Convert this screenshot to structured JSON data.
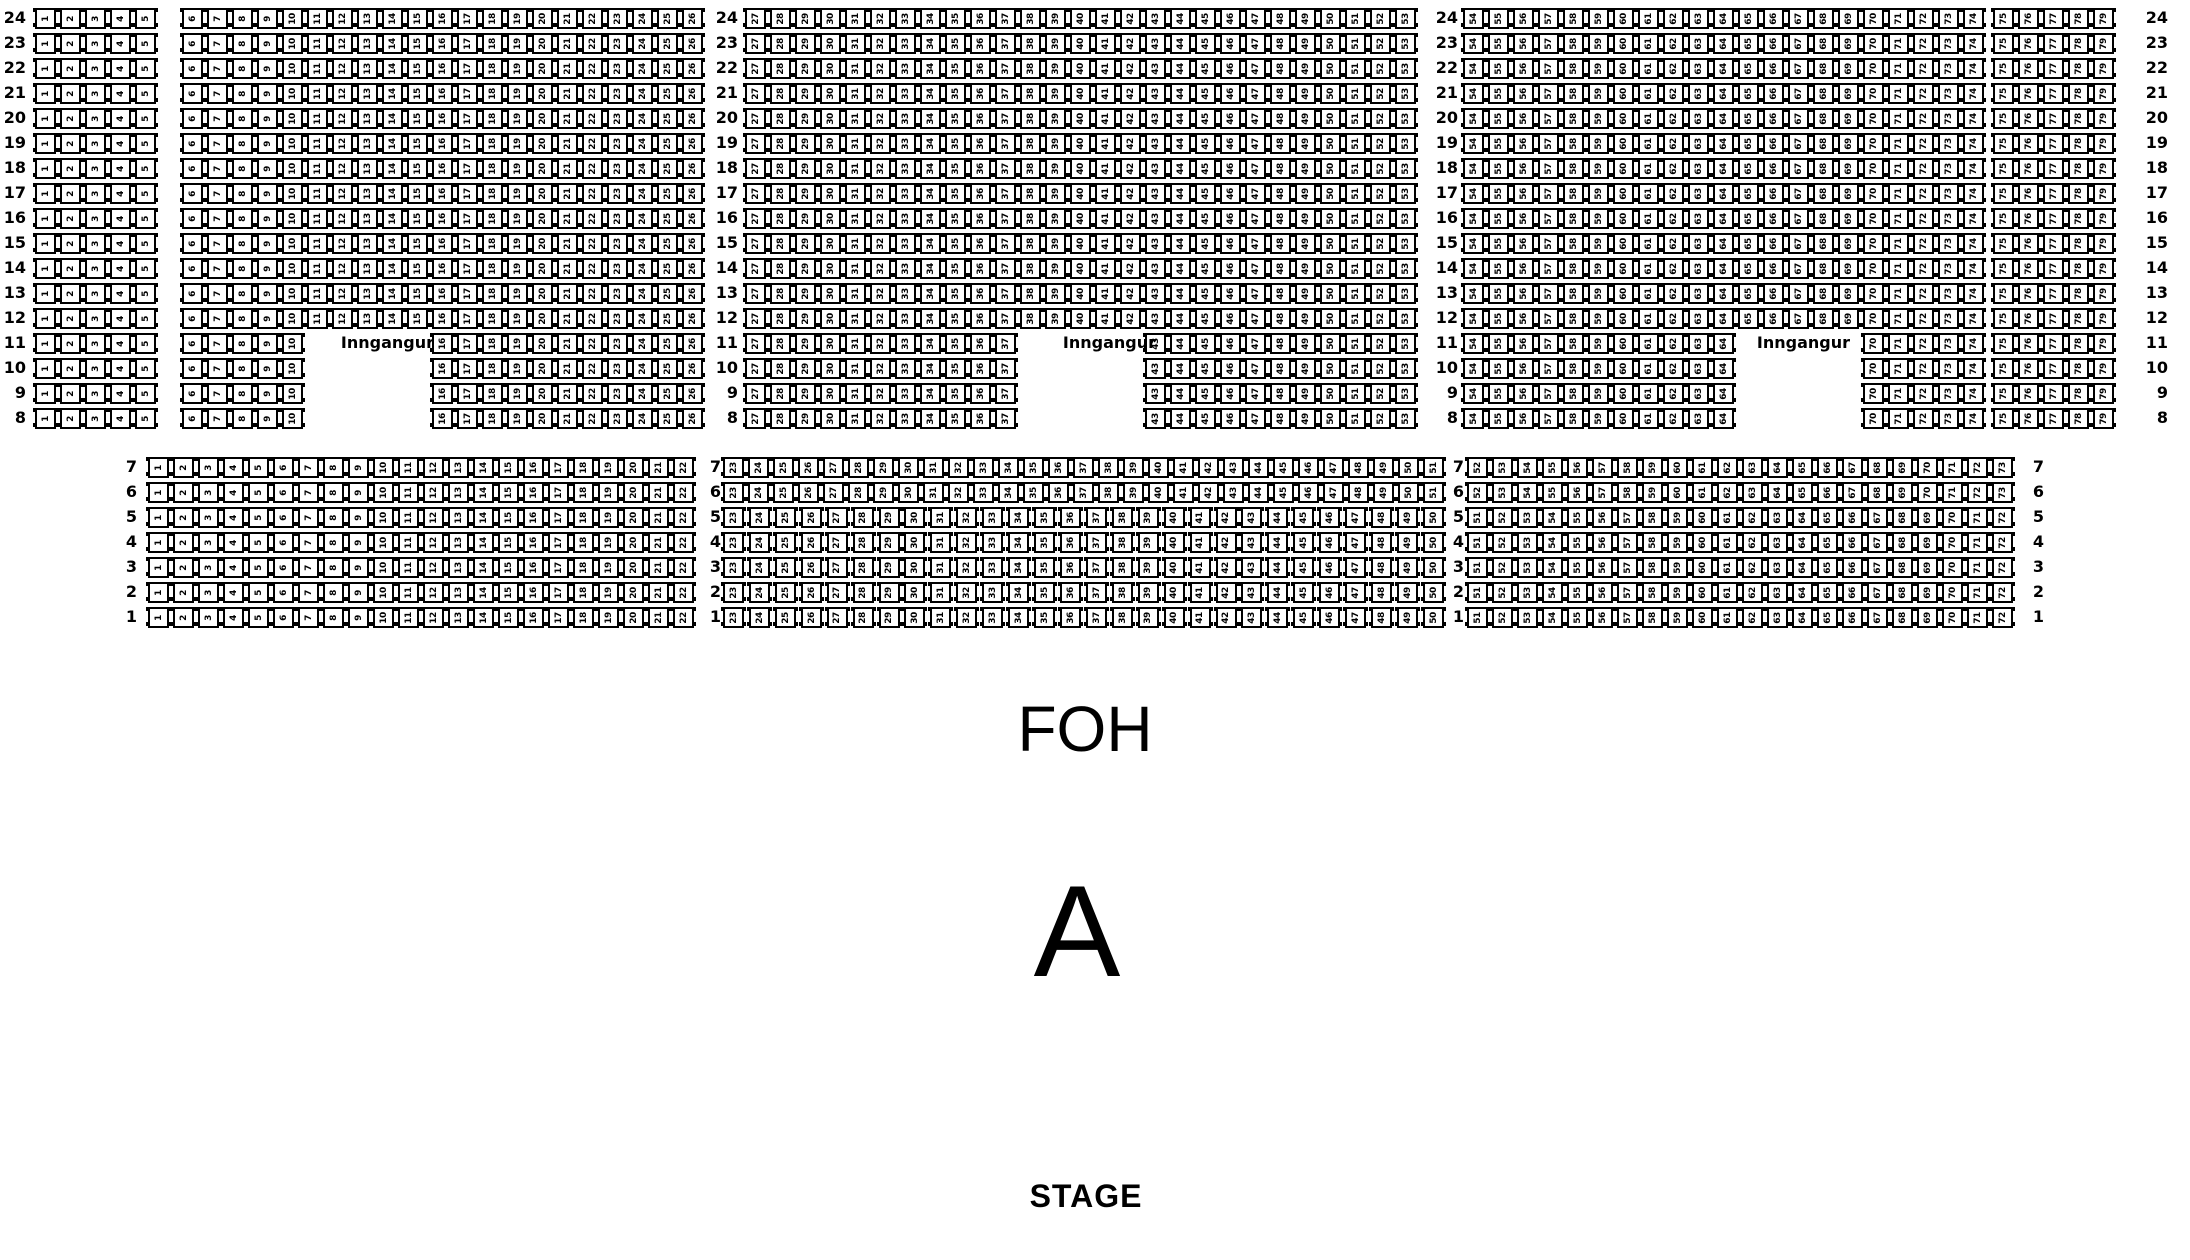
{
  "seat_map": {
    "entrance_label": "Inngangur",
    "foh_label": "FOH",
    "section_label": "A",
    "stage_label": "STAGE",
    "colors": {
      "seat_border": "#000000",
      "seat_fill": "#ffffff",
      "text": "#000000",
      "background": "#ffffff"
    },
    "upper_band": {
      "rows": {
        "from": 24,
        "to": 8
      },
      "blocks": [
        {
          "id": "left-outer",
          "ranges": [
            {
              "rows_from": 24,
              "rows_to": 8,
              "from": 1,
              "to": 5
            }
          ]
        },
        {
          "id": "left-main",
          "ranges": [
            {
              "rows_from": 24,
              "rows_to": 12,
              "from": 6,
              "to": 26
            },
            {
              "rows_from": 11,
              "rows_to": 8,
              "from": 6,
              "to": 26,
              "skip_from": 11,
              "skip_to": 15
            }
          ]
        },
        {
          "id": "center",
          "ranges": [
            {
              "rows_from": 24,
              "rows_to": 12,
              "from": 27,
              "to": 53
            },
            {
              "rows_from": 11,
              "rows_to": 8,
              "from": 27,
              "to": 53,
              "skip_from": 38,
              "skip_to": 42
            }
          ]
        },
        {
          "id": "right-main",
          "ranges": [
            {
              "rows_from": 24,
              "rows_to": 12,
              "from": 54,
              "to": 74
            },
            {
              "rows_from": 11,
              "rows_to": 8,
              "from": 54,
              "to": 74,
              "skip_from": 65,
              "skip_to": 69
            }
          ]
        },
        {
          "id": "right-outer",
          "ranges": [
            {
              "rows_from": 24,
              "rows_to": 8,
              "from": 75,
              "to": 79
            }
          ]
        }
      ]
    },
    "lower_band": {
      "rows": {
        "from": 7,
        "to": 1
      },
      "blocks": [
        {
          "id": "left",
          "ranges": [
            {
              "rows_from": 7,
              "rows_to": 1,
              "from": 1,
              "to": 22
            }
          ]
        },
        {
          "id": "center",
          "ranges": [
            {
              "rows_from": 7,
              "rows_to": 6,
              "from": 23,
              "to": 51
            },
            {
              "rows_from": 5,
              "rows_to": 1,
              "from": 23,
              "to": 50
            }
          ]
        },
        {
          "id": "right",
          "ranges": [
            {
              "rows_from": 7,
              "rows_to": 6,
              "from": 52,
              "to": 73
            },
            {
              "rows_from": 5,
              "rows_to": 1,
              "from": 51,
              "to": 72
            }
          ]
        }
      ]
    }
  }
}
